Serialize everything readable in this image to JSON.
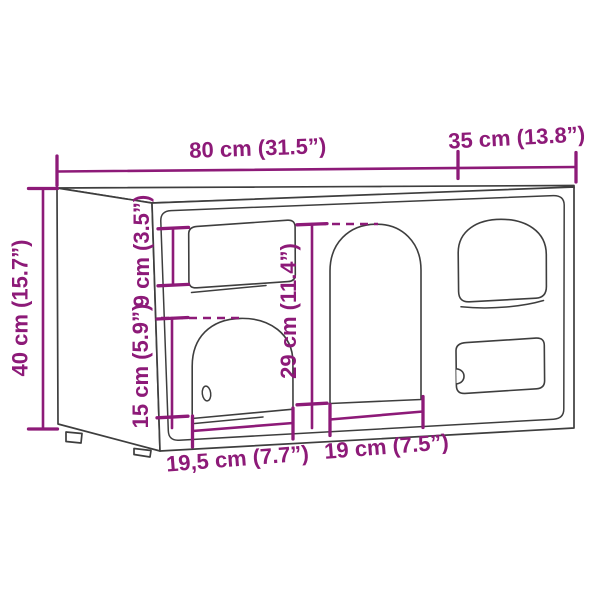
{
  "diagram": {
    "type": "furniture-dimension-diagram",
    "colors": {
      "dimension_accent": "#8d1a78",
      "outline": "#3e3e3e",
      "background": "#ffffff"
    },
    "dimensions": {
      "overall_width": {
        "text": "80 cm (31.5”)"
      },
      "overall_depth": {
        "text": "35 cm (13.8”)"
      },
      "overall_height": {
        "text": "40 cm (15.7”)"
      },
      "top_opening_height": {
        "text": "9 cm (3.5”)"
      },
      "left_door_height": {
        "text": "15 cm (5.9”)"
      },
      "center_opening_height": {
        "text": "29 cm (11.4”)"
      },
      "left_door_width": {
        "text": "19,5 cm (7.7”)"
      },
      "center_opening_width": {
        "text": "19 cm (7.5”)"
      }
    }
  }
}
